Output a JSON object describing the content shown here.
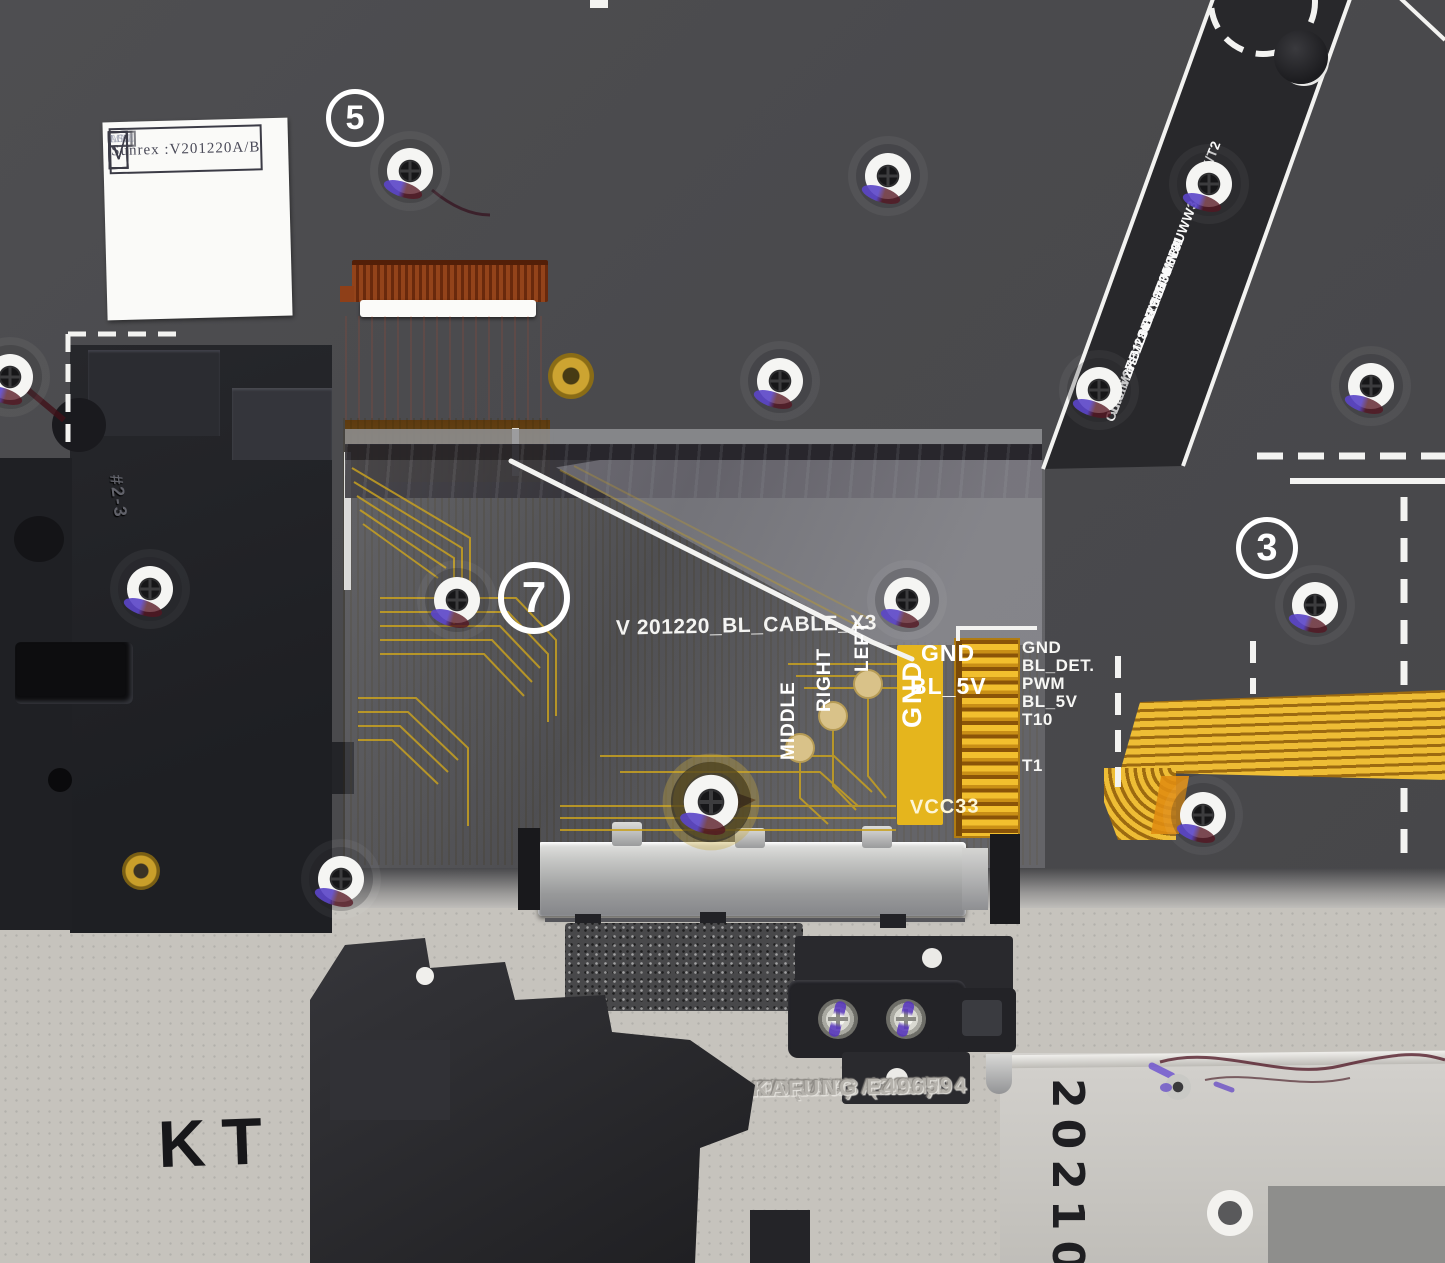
{
  "sunrex": {
    "title": "Sunrex :V201220A/B",
    "headers": [
      "LFC",
      "LOT",
      "MDL",
      "ASM"
    ],
    "checks": [
      "√",
      "√",
      "√",
      "√"
    ]
  },
  "circled_numbers": {
    "five": "5",
    "seven": "7",
    "three": "3"
  },
  "flex_cable": {
    "name": "V 201220_BL_CABLE_X3",
    "pad_labels": [
      "MIDDLE",
      "RIGHT",
      "LEFT"
    ],
    "gnd_vertical": "GND",
    "gnd": "GND",
    "bl_5v": "BL_5V",
    "vcc": "VCC33"
  },
  "connector": {
    "labels": [
      "GND",
      "BL_DET.",
      "PWM",
      "BL_5V",
      "T10",
      "T1"
    ]
  },
  "strip": {
    "lines": [
      "HY 2105",
      "VF:□V27□V28■V29□V30□V31",
      "H W010UWW3638HX/T2",
      "Lumines:□L36■L38",
      "Color: □HB1□HB2□HB3■HB4"
    ]
  },
  "emboss": {
    "lines": [
      "HX4B0(PRI)",
      "Metal Part (AZ9)D",
      "Kashui  #3",
      "Plastic  Part",
      "TORAY  A305M",
      "KAFUNG E496594"
    ]
  },
  "marks": {
    "kt_stamp": "KT",
    "part_mark": "#2-3",
    "date_code": "20210"
  },
  "colors": {
    "plate": "#4b4b4e",
    "palmrest": "#c6c3bd",
    "flex_olive": "#75641f",
    "flex_gold": "#eebd35",
    "paint_purple": "#5b45c8",
    "accent_yellow": "#e5b51d"
  }
}
